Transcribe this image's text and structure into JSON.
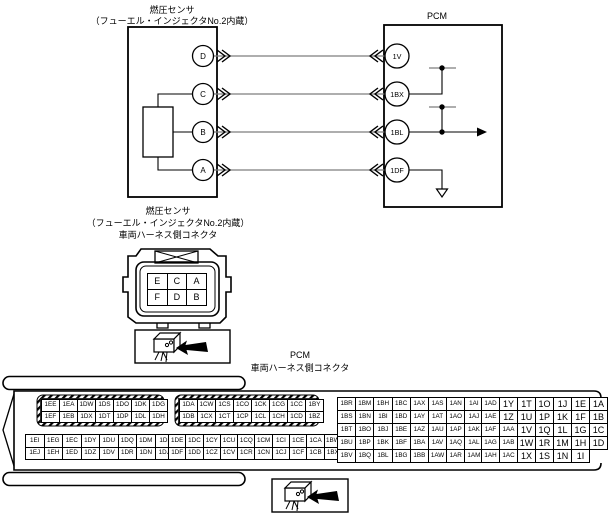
{
  "diagram": {
    "sensor": {
      "title_line1": "燃圧センサ",
      "title_line2": "（フューエル・インジェクタNo.2内蔵）",
      "pins": [
        "D",
        "C",
        "B",
        "A"
      ]
    },
    "pcm": {
      "title": "PCM",
      "pins": [
        "1V",
        "1BX",
        "1BL",
        "1DF"
      ]
    }
  },
  "sensor_connector": {
    "label_line1": "燃圧センサ",
    "label_line2": "（フューエル・インジェクタNo.2内蔵）",
    "label_line3": "車両ハーネス側コネクタ",
    "pin_grid": [
      [
        "E",
        "C",
        "A"
      ],
      [
        "F",
        "D",
        "B"
      ]
    ]
  },
  "pcm_connector": {
    "label_line1": "PCM",
    "label_line2": "車両ハーネス側コネクタ",
    "blocks": {
      "top_left": [
        [
          "1EE",
          "1EA",
          "1DW",
          "1DS",
          "1DO",
          "1DK",
          "1DG"
        ],
        [
          "1EF",
          "1EB",
          "1DX",
          "1DT",
          "1DP",
          "1DL",
          "1DH"
        ]
      ],
      "top_mid": [
        [
          "1DA",
          "1CW",
          "1CS",
          "1CO",
          "1CK",
          "1CG",
          "1CC",
          "1BY"
        ],
        [
          "1DB",
          "1CX",
          "1CT",
          "1CP",
          "1CL",
          "1CH",
          "1CD",
          "1BZ"
        ]
      ],
      "bottom_left": [
        [
          "1EI",
          "1EG",
          "1EC",
          "1DY",
          "1DU",
          "1DQ",
          "1DM",
          "1DI"
        ],
        [
          "1EJ",
          "1EH",
          "1ED",
          "1DZ",
          "1DV",
          "1DR",
          "1DN",
          "1DJ"
        ]
      ],
      "bottom_mid": [
        [
          "1DE",
          "1DC",
          "1CY",
          "1CU",
          "1CQ",
          "1CM",
          "1CI",
          "1CE",
          "1CA",
          "1BW"
        ],
        [
          "1DF",
          "1DD",
          "1CZ",
          "1CV",
          "1CR",
          "1CN",
          "1CJ",
          "1CF",
          "1CB",
          "1BX"
        ]
      ],
      "right_a": [
        [
          "1BR",
          "1BM",
          "1BH",
          "1BC",
          "1AX",
          "1AS",
          "1AN",
          "1AI"
        ],
        [
          "1BS",
          "1BN",
          "1BI",
          "1BD",
          "1AY",
          "1AT",
          "1AO",
          "1AJ"
        ],
        [
          "1BT",
          "1BO",
          "1BJ",
          "1BE",
          "1AZ",
          "1AU",
          "1AP",
          "1AK"
        ],
        [
          "1BU",
          "1BP",
          "1BK",
          "1BF",
          "1BA",
          "1AV",
          "1AQ",
          "1AL"
        ],
        [
          "1BV",
          "1BQ",
          "1BL",
          "1BG",
          "1BB",
          "1AW",
          "1AR",
          "1AM"
        ]
      ],
      "right_b": [
        [
          "1AD",
          "1Y",
          "1T",
          "1O",
          "1J",
          "1E",
          "1A"
        ],
        [
          "1AE",
          "1Z",
          "1U",
          "1P",
          "1K",
          "1F",
          "1B"
        ],
        [
          "1AF",
          "1AA",
          "1V",
          "1Q",
          "1L",
          "1G",
          "1C"
        ],
        [
          "1AG",
          "1AB",
          "1W",
          "1R",
          "1M",
          "1H",
          "1D"
        ],
        [
          "1AH",
          "1AC",
          "1X",
          "1S",
          "1N",
          "1I",
          ""
        ]
      ]
    }
  },
  "icons": {
    "callout": "connector-arrow-icon",
    "ground": "ground-icon",
    "continuation": "right-arrow-icon"
  },
  "colors": {
    "line": "#000000",
    "wire": "#7d7d7d",
    "background": "#ffffff"
  }
}
